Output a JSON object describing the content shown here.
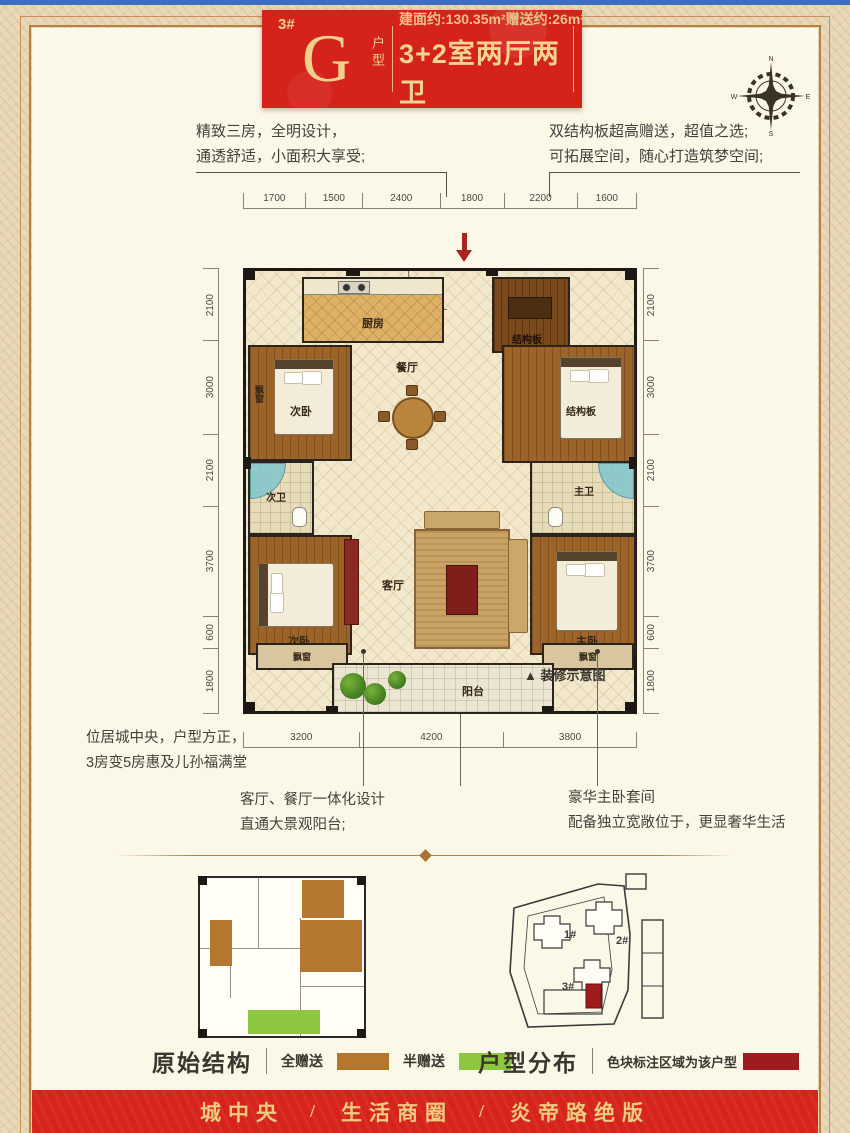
{
  "page": {
    "accent_red": "#d5231c",
    "gold": "#f0cf8a",
    "frame_brown": "#b5813f",
    "bg_inner": "#fcf8e8",
    "bg_outer": "#e9d9ba",
    "wall_black": "#1d1813"
  },
  "badge": {
    "building": "3#",
    "letter": "G",
    "letter_suffix": "户型",
    "area_line": "建面约:130.35m²赠送约:26m²",
    "layout_line": "3+2室两厅两卫"
  },
  "compass": {
    "n": "N",
    "e": "E",
    "s": "S",
    "w": "W"
  },
  "intro": {
    "left1": "精致三房，全明设计，",
    "left2": "通透舒适，小面积大享受;",
    "right1": "双结构板超高赠送，超值之选;",
    "right2": "可拓展空间，随心打造筑梦空间;"
  },
  "floorplan": {
    "dims_top": [
      "1700",
      "1500",
      "2400",
      "1800",
      "2200",
      "1600"
    ],
    "dims_side": [
      "2100",
      "3000",
      "2100",
      "3700",
      "600",
      "1800"
    ],
    "dims_bottom": [
      "3200",
      "4200",
      "3800"
    ],
    "rooms": {
      "kitchen": "厨房",
      "dining": "餐厅",
      "structure_top": "结构板",
      "structure_mid": "结构板",
      "bedroom_upper": "次卧",
      "bedroom_lower": "次卧",
      "bath_secondary": "次卫",
      "bath_master": "主卫",
      "living": "客厅",
      "master": "主卧",
      "balcony": "阳台",
      "bay_window": "飘窗"
    },
    "note": "▲ 装修示意图"
  },
  "captions": {
    "left1": "位居城中央，户型方正，",
    "left2": "3房变5房惠及儿孙福满堂",
    "center1": "客厅、餐厅一体化设计",
    "center2": "直通大景观阳台;",
    "right1": "豪华主卧套间",
    "right2": "配备独立宽敞位于，更显奢华生活"
  },
  "original_structure": {
    "title": "原始结构",
    "legend_full": "全赠送",
    "legend_half": "半赠送",
    "full_color": "#b5762f",
    "half_color": "#8dc63f"
  },
  "distribution": {
    "title": "户型分布",
    "legend": "色块标注区域为该户型",
    "highlight_color": "#9e1b1e",
    "buildings": [
      "1#",
      "2#",
      "3#"
    ]
  },
  "footer": {
    "item1": "城中央",
    "item2": "生活商圈",
    "item3": "炎帝路绝版",
    "sep": "/"
  }
}
